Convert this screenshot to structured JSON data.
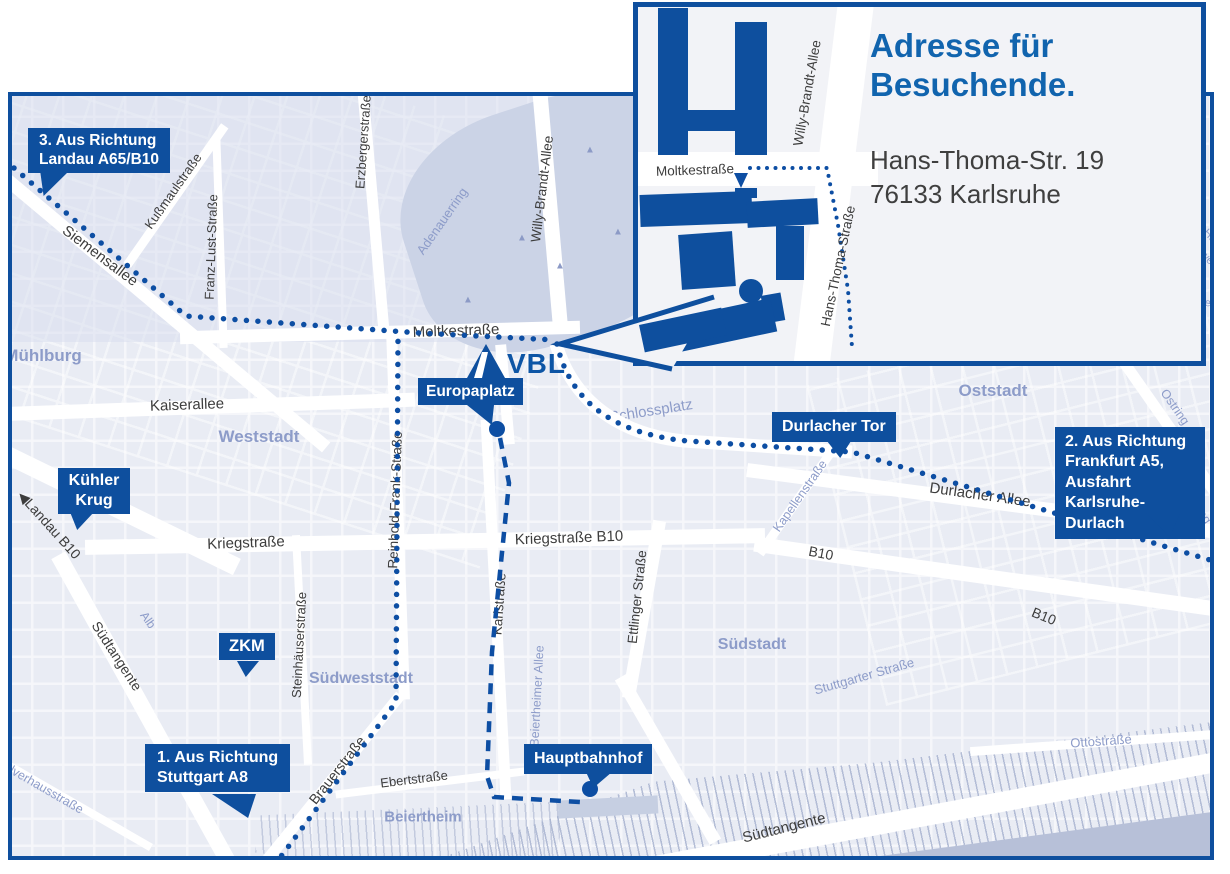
{
  "colors": {
    "accent_blue": "#0e4f9e",
    "title_blue": "#1164ae",
    "route_blue": "#0d4ea3",
    "map_bg": "#e9ecf4",
    "district_text": "#8d9cc9",
    "street_text": "#3d3d3d"
  },
  "inset": {
    "title": "Adresse für\nBesuchende.",
    "address": "Hans-Thoma-Str. 19\n76133 Karlsruhe",
    "streets": {
      "moltke": "Moltkestraße",
      "willy_brandt": "Willy-Brandt-Allee",
      "hans_thoma": "Hans-Thoma-Straße"
    }
  },
  "logo": {
    "text": "VBL"
  },
  "callouts": {
    "landau": {
      "text": "3. Aus Richtung\nLandau A65/B10"
    },
    "kuehler_krug": {
      "text": "Kühler\nKrug"
    },
    "zkm": {
      "text": "ZKM"
    },
    "stuttgart": {
      "text": "1. Aus Richtung\nStuttgart A8"
    },
    "europaplatz": {
      "text": "Europaplatz"
    },
    "durlacher_tor": {
      "text": "Durlacher Tor"
    },
    "hauptbahnhof": {
      "text": "Hauptbahnhof"
    },
    "frankfurt": {
      "text": "2. Aus Richtung\nFrankfurt A5,\nAusfahrt\nKarlsruhe-Durlach"
    }
  },
  "streets": {
    "siemensallee": "Siemensallee",
    "kussmaul": "Kußmaulstraße",
    "franz_lust": "Franz-Lust-Straße",
    "erzberger": "Erzbergerstraße",
    "willy_brandt": "Willy-Brandt-Allee",
    "moltke": "Moltkestraße",
    "kaiserallee": "Kaiserallee",
    "kriegstrasse": "Kriegstraße",
    "kriegstrasse_b10": "Kriegstraße B10",
    "reinhold_frank": "Reinhold-Frank-Straße",
    "karlstrasse": "Karlstraße",
    "ettlinger": "Ettlinger Straße",
    "durlacher_allee": "Durlacher Allee",
    "b10": "B10",
    "landau_b10": "◀Landau B10",
    "suedtangente": "Südtangente",
    "brauerstrasse": "Brauerstraße",
    "ebertstrasse": "Ebertstraße",
    "steinhaeuser": "Steinhäuserstraße",
    "adenauerring": "Adenauerring",
    "schlossplatz": "Schlossplatz",
    "kapellenstrasse": "Kapellenstraße",
    "ostring": "Ostring",
    "alb": "Alb",
    "beiertheimer_allee": "Beiertheimer Allee",
    "stuttgarter": "Stuttgarter Straße",
    "ottostrasse": "Ottostraße",
    "pulverhaus": "Pulverhausstraße"
  },
  "districts": {
    "muehlburg": "Mühlburg",
    "weststadt": "Weststadt",
    "oststadt": "Oststadt",
    "suedweststadt": "Südweststadt",
    "suedstadt": "Südstadt",
    "beiertheim": "Beiertheim"
  },
  "fragments": {
    "f1": "Ha",
    "f2": "we",
    "f3": "ein"
  }
}
